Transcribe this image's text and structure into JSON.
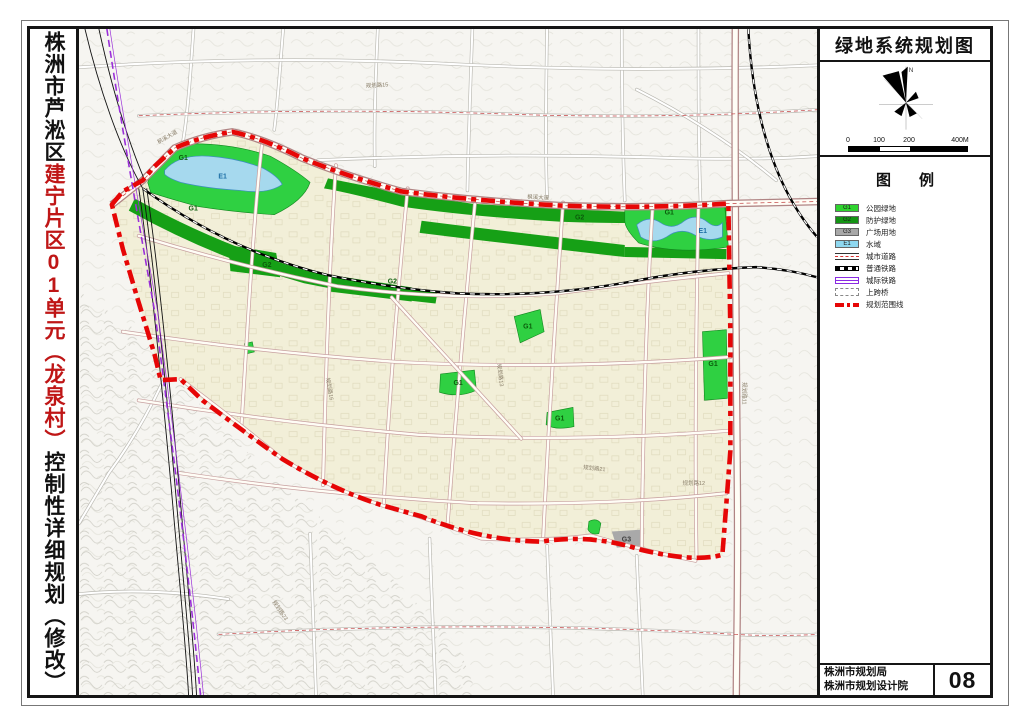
{
  "title_strip": {
    "prefix": "株洲市芦淞区",
    "red_part1": "建宁片区",
    "red_number": "01",
    "red_part2": "单元（龙泉村）",
    "suffix": "控制性详细规划（修改）"
  },
  "right_panel": {
    "map_title": "绿地系统规划图",
    "compass_label": "N",
    "scale_bar": {
      "ticks": [
        "0",
        "100",
        "200",
        "400M"
      ]
    },
    "legend": {
      "header": "图例",
      "items": [
        {
          "code": "G1",
          "label": "公园绿地",
          "color": "#2fd42f"
        },
        {
          "code": "G2",
          "label": "防护绿地",
          "color": "#149414"
        },
        {
          "code": "G3",
          "label": "广场用地",
          "color": "#a8a8a8"
        },
        {
          "code": "E1",
          "label": "水域",
          "color": "#8fd8f0"
        },
        {
          "label": "城市道路"
        },
        {
          "label": "普通铁路"
        },
        {
          "label": "城际铁路"
        },
        {
          "label": "上跨桥"
        },
        {
          "label": "规划范围线"
        }
      ]
    },
    "title_block": {
      "agency_line1": "株洲市规划局",
      "agency_line2": "株洲市规划设计院",
      "sheet_number": "08"
    }
  },
  "map": {
    "zone_labels": [
      {
        "text": "G1"
      },
      {
        "text": "E1"
      },
      {
        "text": "G1"
      },
      {
        "text": "G2"
      },
      {
        "text": "G2"
      },
      {
        "text": "G2"
      },
      {
        "text": "G1"
      },
      {
        "text": "E1"
      },
      {
        "text": "G1"
      },
      {
        "text": "G1"
      },
      {
        "text": "G1"
      },
      {
        "text": "G1"
      },
      {
        "text": "G3"
      }
    ],
    "road_labels": [
      {
        "text": "枫溪大道"
      },
      {
        "text": "枫溪大道"
      },
      {
        "text": "规划路12"
      },
      {
        "text": "规划路15"
      },
      {
        "text": "规划路13"
      },
      {
        "text": "规划路16"
      },
      {
        "text": "规划路21"
      },
      {
        "text": "规划路23"
      },
      {
        "text": "规划路11"
      }
    ],
    "colors": {
      "park_green": "#2fd042",
      "protect_green": "#16a016",
      "square_gray": "#a9a9a9",
      "water_blue": "#a6d9ee",
      "boundary_red": "#e60606",
      "intercity_purple": "#9a2fd8",
      "planning_area": "#f2efd8"
    }
  }
}
